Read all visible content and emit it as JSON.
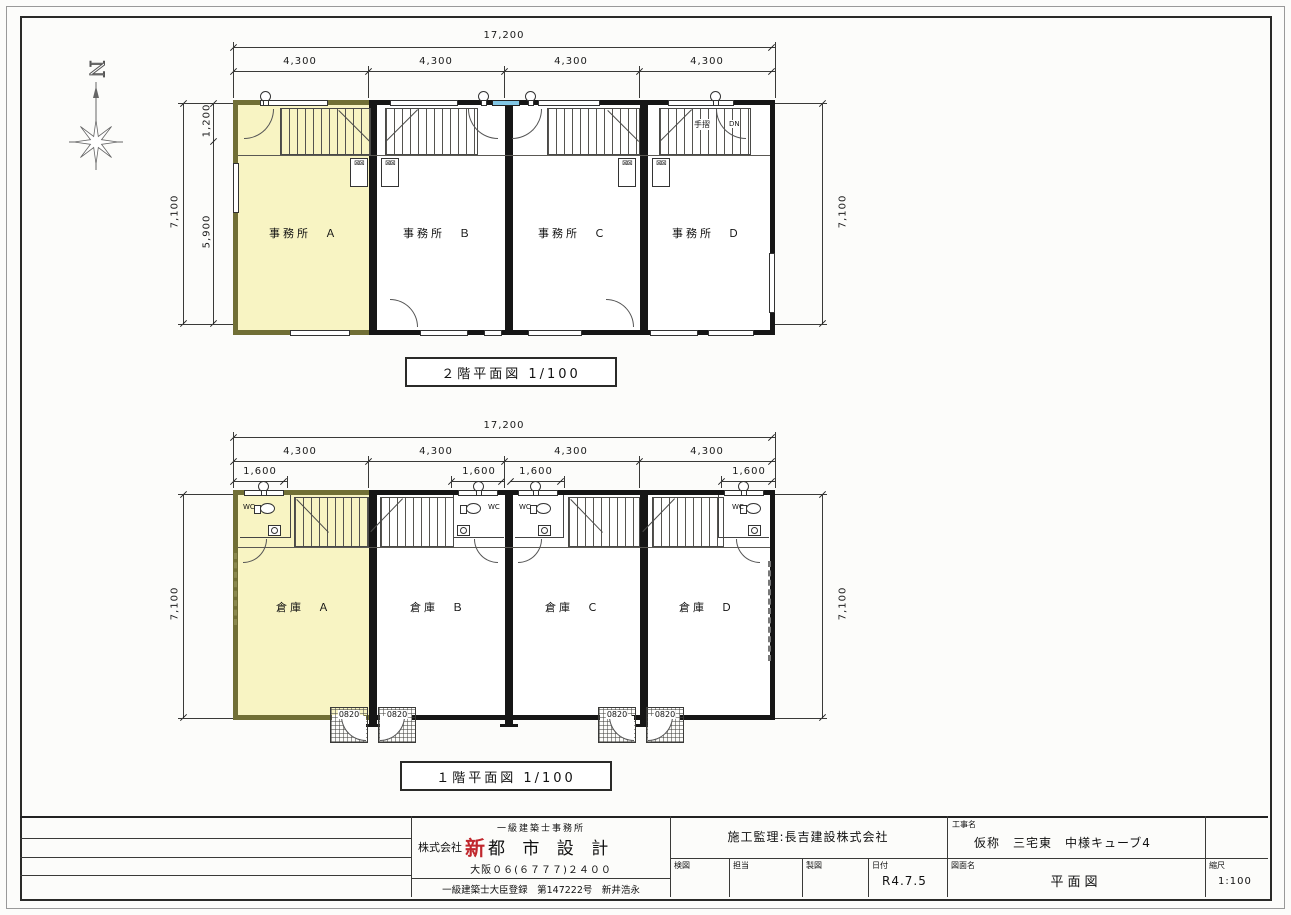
{
  "colors": {
    "highlight_yellow": "#f8f4c3",
    "highlight_wall_olive": "#716f35",
    "window_blue": "#82c7e6",
    "accent_red": "#c0272d"
  },
  "compass": {
    "letter": "N"
  },
  "plan_2f": {
    "caption": "２階平面図  1/100",
    "dim_total": "17,200",
    "dim_bays": [
      "4,300",
      "4,300",
      "4,300",
      "4,300"
    ],
    "dim_left_outer": "7,100",
    "dim_left_upper": "1,200",
    "dim_left_lower": "5,900",
    "dim_right": "7,100",
    "rooms": [
      "事務所　Ａ",
      "事務所　Ｂ",
      "事務所　Ｃ",
      "事務所　Ｄ"
    ],
    "handrail_label": "手摺",
    "down_label": "DN"
  },
  "plan_1f": {
    "caption": "１階平面図  1/100",
    "dim_total": "17,200",
    "dim_bays": [
      "4,300",
      "4,300",
      "4,300",
      "4,300"
    ],
    "dim_entries": [
      "1,600",
      "1,600",
      "1,600",
      "1,600"
    ],
    "dim_left": "7,100",
    "dim_right": "7,100",
    "rooms": [
      "倉庫　Ａ",
      "倉庫　Ｂ",
      "倉庫　Ｃ",
      "倉庫　Ｄ"
    ],
    "wc": [
      "WC",
      "WC",
      "WC",
      "WC"
    ],
    "door_tags": [
      "0820",
      "0820",
      "0820",
      "0820"
    ]
  },
  "title_block": {
    "office_type": "一級建築士事務所",
    "company_prefix": "株式会社",
    "company_accent": "新",
    "company_name": "都 市 設 計",
    "phone": "大阪０６(６７７７)２４００",
    "registration": "一級建築士大臣登録　第147222号　新井浩永",
    "supervision": "施工監理:長吉建設株式会社",
    "project_label": "工事名",
    "project_name": "仮称　三宅東　中様キューブ4",
    "check_label": "検図",
    "staff_label": "担当",
    "draft_label": "製図",
    "date_label": "日付",
    "date_value": "R4.7.5",
    "sheet_label": "図面名",
    "sheet_name": "平面図",
    "scale_label": "縮尺",
    "scale_value": "1:100"
  }
}
